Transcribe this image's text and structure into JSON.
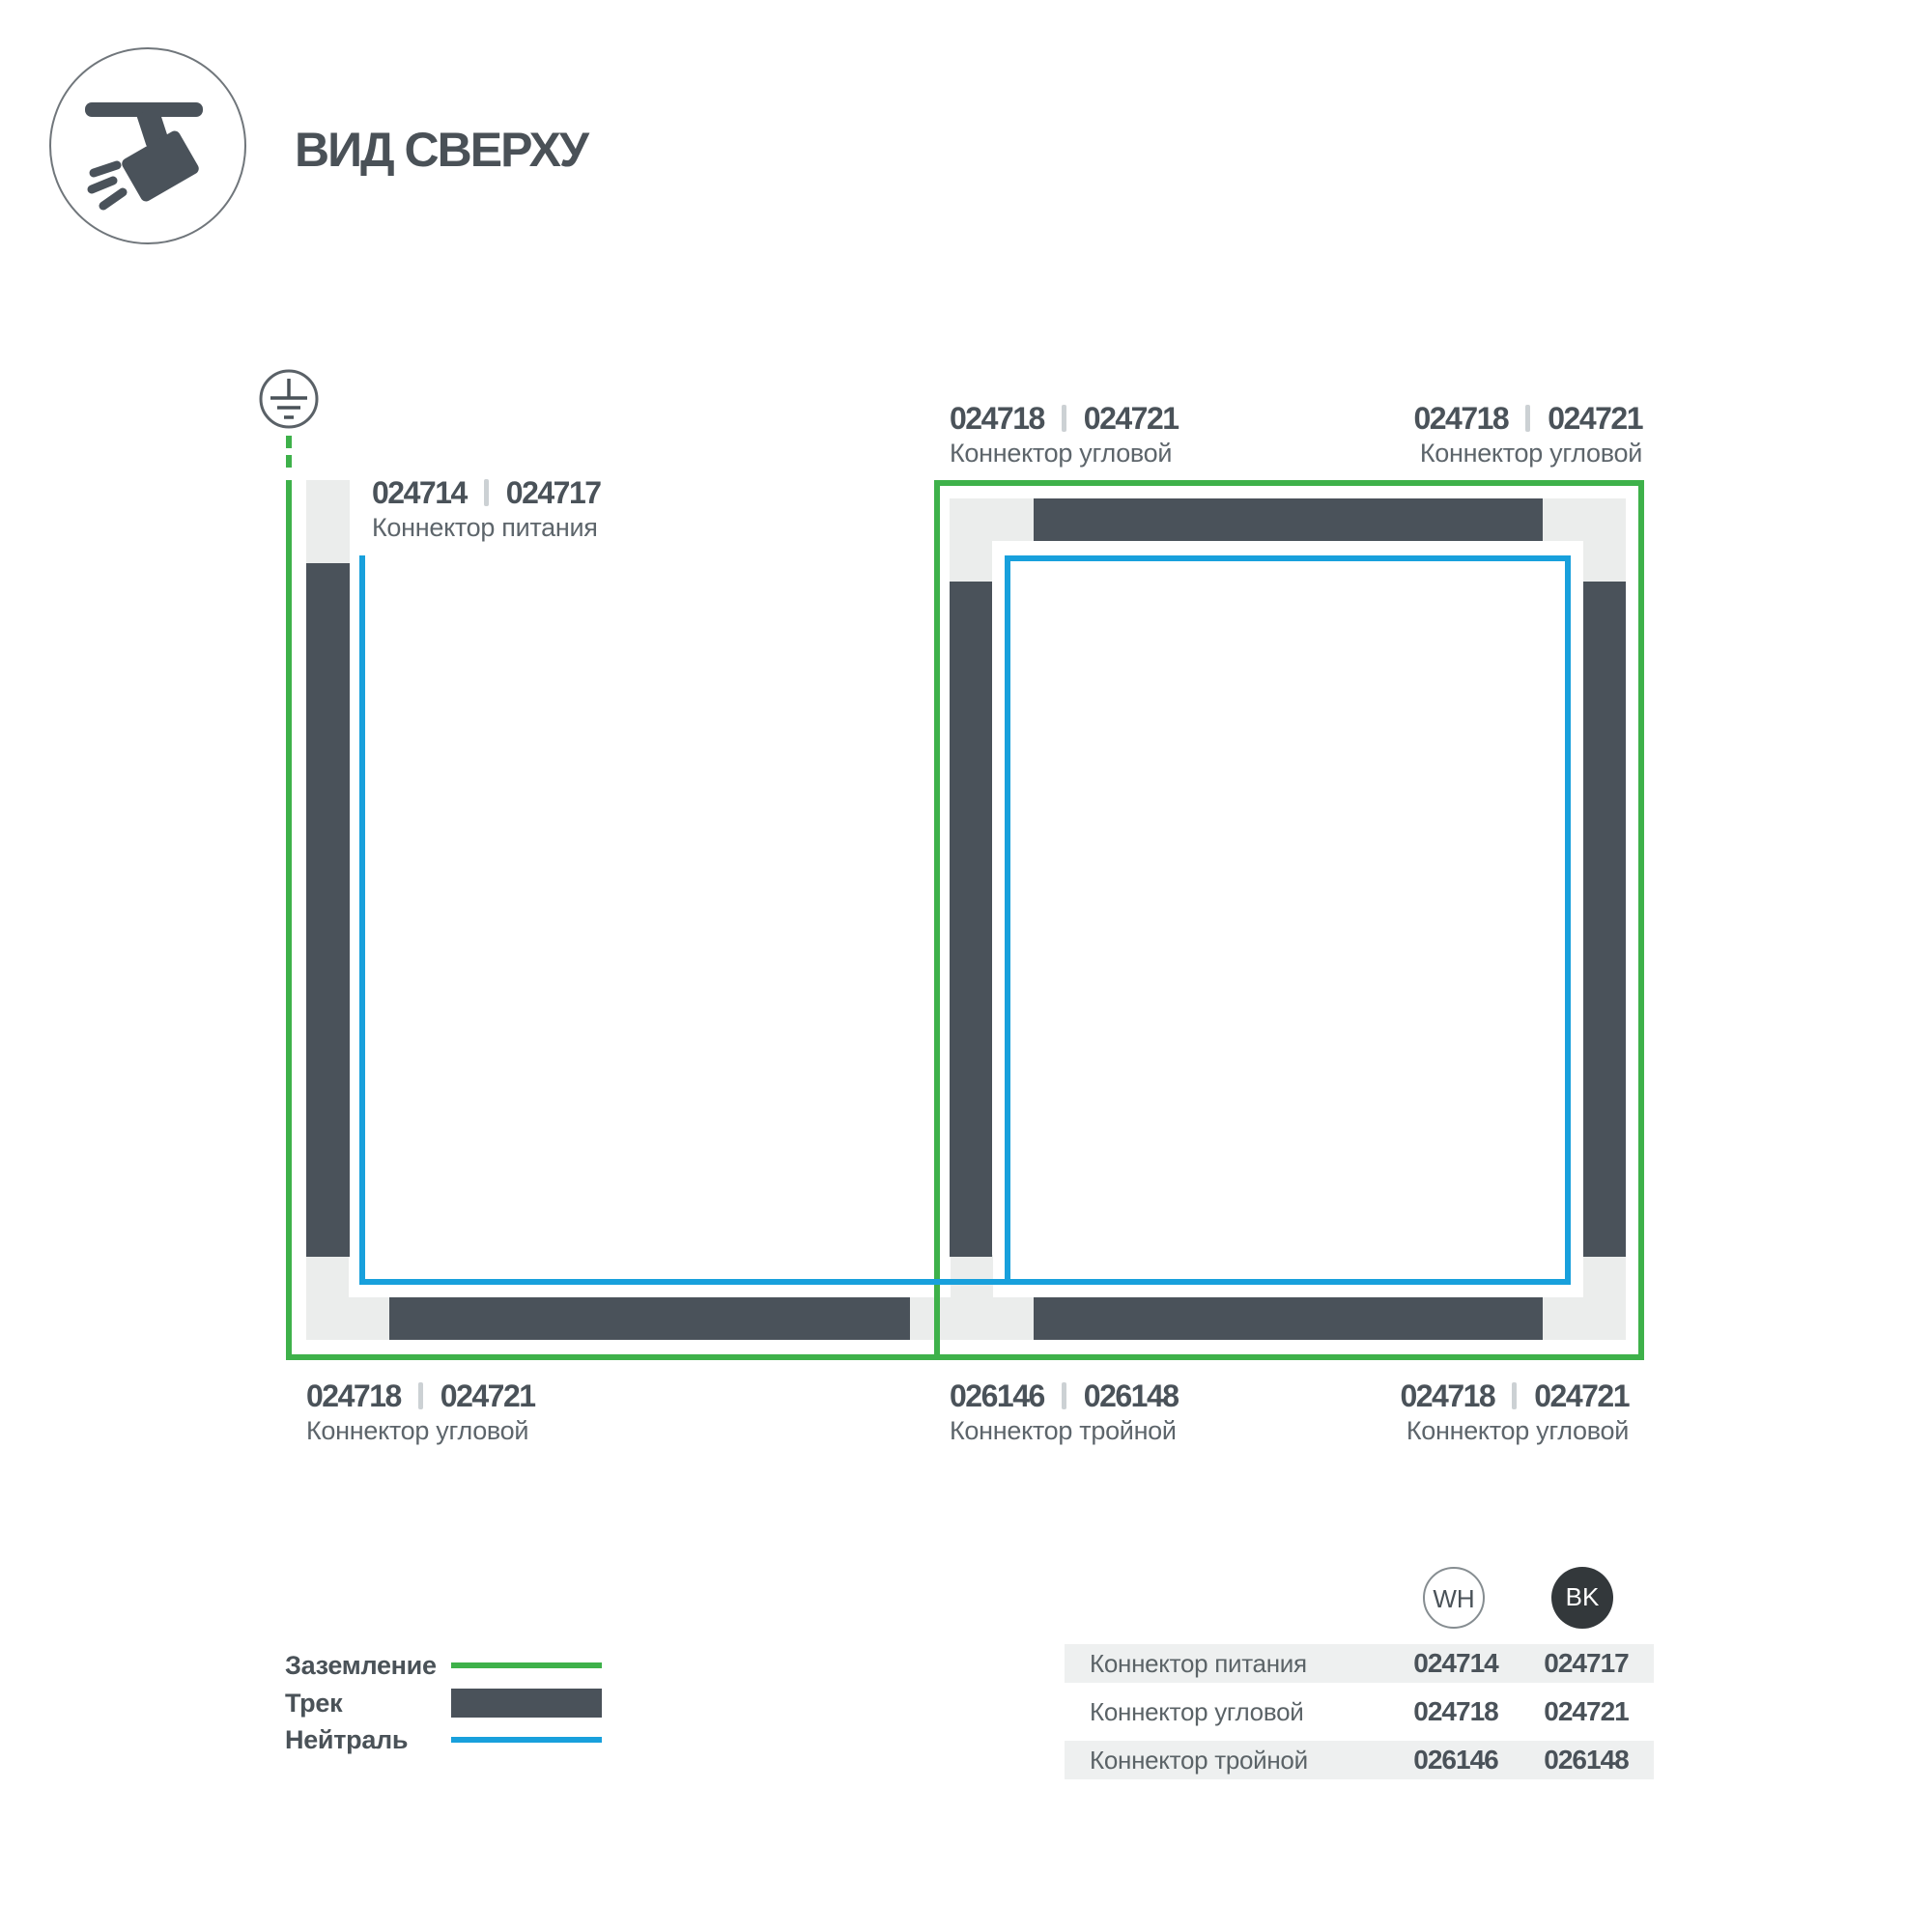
{
  "header": {
    "title": "ВИД СВЕРХУ",
    "icon": "track-spotlight-icon"
  },
  "diagram": {
    "ground_symbol_icon": "earth-ground-icon",
    "callouts": {
      "power": {
        "code_wh": "024714",
        "code_bk": "024717",
        "caption": "Коннектор питания"
      },
      "corner": {
        "code_wh": "024718",
        "code_bk": "024721",
        "caption": "Коннектор угловой"
      },
      "triple": {
        "code_wh": "026146",
        "code_bk": "026148",
        "caption": "Коннектор тройной"
      }
    }
  },
  "legend": {
    "ground": "Заземление",
    "track": "Трек",
    "neutral": "Нейтраль"
  },
  "table": {
    "columns": {
      "wh": "WH",
      "bk": "BK"
    },
    "rows": [
      {
        "name": "Коннектор питания",
        "wh": "024714",
        "bk": "024717"
      },
      {
        "name": "Коннектор угловой",
        "wh": "024718",
        "bk": "024721"
      },
      {
        "name": "Коннектор тройной",
        "wh": "026146",
        "bk": "026148"
      }
    ]
  },
  "colors": {
    "ground_line": "#3eb14a",
    "neutral_line": "#18a0dc",
    "track": "#4a525a",
    "connector": "#ebedec",
    "text_dark": "#4a5259",
    "text_caption": "#5d656b",
    "row_shade": "#eef0f0",
    "badge_bk_fill": "#33383b"
  }
}
